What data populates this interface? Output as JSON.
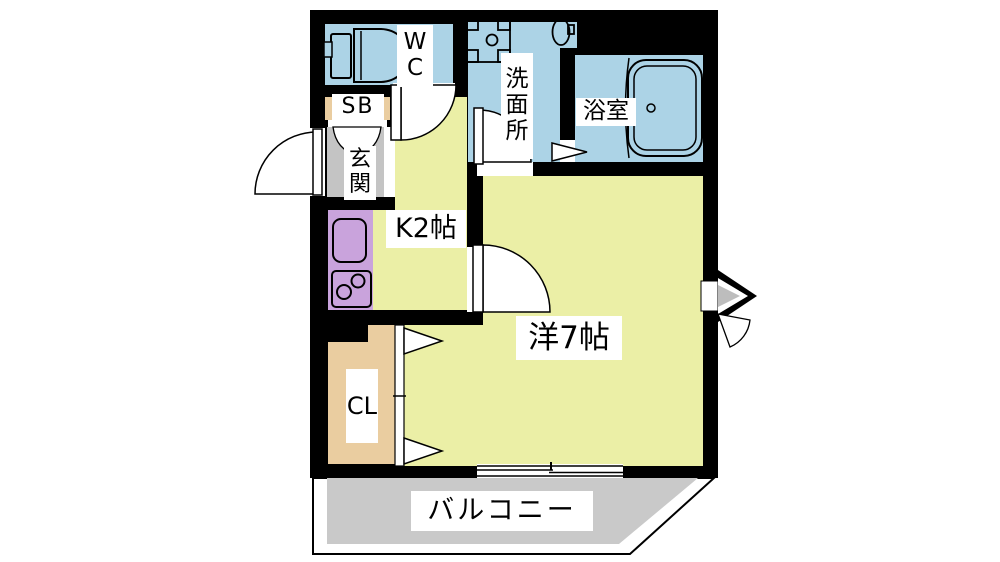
{
  "title": "apartment-floor-plan",
  "rooms": {
    "wc": {
      "label": "WC"
    },
    "washroom": {
      "label": "洗面所"
    },
    "bathroom": {
      "label": "浴室"
    },
    "shoe_box": {
      "label": "SB"
    },
    "entrance": {
      "label": "玄関"
    },
    "kitchen": {
      "label": "K2帖"
    },
    "western_room": {
      "label": "洋7帖"
    },
    "closet": {
      "label": "CL"
    },
    "balcony": {
      "label": "バルコニー"
    }
  },
  "fixtures": [
    "toilet-icon",
    "washing-machine-icon",
    "washbasin-icon",
    "bathtub-icon",
    "kitchen-sink-icon",
    "stove-icon",
    "door-swing-icon",
    "double-door-icon",
    "folding-closet-door-icon",
    "folding-bath-door-icon",
    "sliding-window-icon",
    "entry-arrow-icon"
  ],
  "colors": {
    "wall": "#000000",
    "background": "#ffffff",
    "wet_rooms": "#acd3e6",
    "living_rooms": "#ebefa6",
    "kitchen_counter": "#c9a3dc",
    "entrance_floor": "#c4c4c4",
    "storage": "#eacda0",
    "balcony_floor": "#c9c9c9",
    "label_box": "#ffffff"
  }
}
